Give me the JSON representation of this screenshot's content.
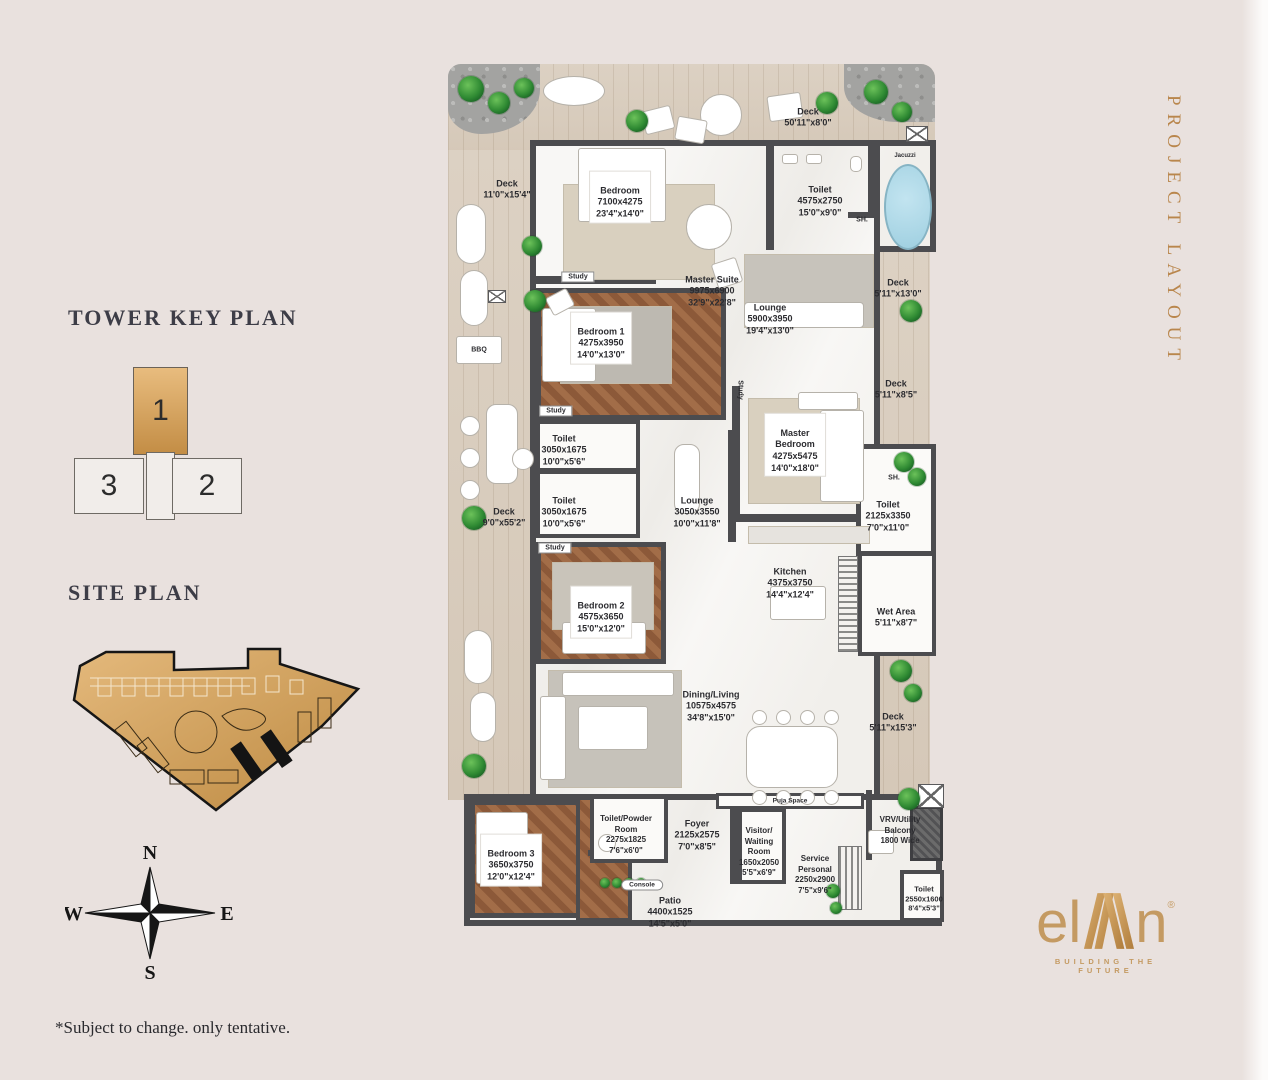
{
  "titles": {
    "tower_key_plan": "TOWER KEY PLAN",
    "site_plan": "SITE PLAN",
    "project_layout": "PROJECT LAYOUT",
    "disclaimer": "*Subject to change. only tentative."
  },
  "tower_key_plan": {
    "unit_highlight": "1",
    "unit_left": "3",
    "unit_right": "2"
  },
  "compass": {
    "n": "N",
    "e": "E",
    "s": "S",
    "w": "W"
  },
  "logo": {
    "brand_prefix": "el",
    "brand_suffix": "n",
    "registered": "®",
    "tagline": "BUILDING THE FUTURE"
  },
  "colors": {
    "gold": "#c49a62",
    "wall": "#4c4c4f",
    "wood": "#d9cec0",
    "background": "#e9e1de",
    "jacuzzi_blue": "#a9d6e6"
  },
  "rooms": {
    "deck_top": {
      "n": "Deck",
      "f": "50'11\"x8'0\""
    },
    "deck_left_top": {
      "n": "Deck",
      "f": "11'0\"x15'4\""
    },
    "bedroom_top": {
      "n": "Bedroom",
      "m": "7100x4275",
      "f": "23'4\"x14'0\""
    },
    "toilet_top": {
      "n": "Toilet",
      "m": "4575x2750",
      "f": "15'0\"x9'0\""
    },
    "sh": {
      "n": "SH."
    },
    "jacuzzi": {
      "n": "Jacuzzi"
    },
    "master_suite": {
      "n": "Master Suite",
      "m": "9975x6900",
      "f": "32'9\"x22'8\""
    },
    "lounge_top": {
      "n": "Lounge",
      "m": "5900x3950",
      "f": "19'4\"x13'0\""
    },
    "deck_right_1": {
      "n": "Deck",
      "f": "5'11\"x13'0\""
    },
    "bedroom1": {
      "n": "Bedroom 1",
      "m": "4275x3950",
      "f": "14'0\"x13'0\""
    },
    "bbq": {
      "n": "BBQ"
    },
    "study": {
      "n": "Study"
    },
    "deck_right_2": {
      "n": "Deck",
      "f": "5'11\"x8'5\""
    },
    "toilet_a": {
      "n": "Toilet",
      "m": "3050x1675",
      "f": "10'0\"x5'6\""
    },
    "toilet_b": {
      "n": "Toilet",
      "m": "3050x1675",
      "f": "10'0\"x5'6\""
    },
    "master_bedroom": {
      "n": "Master\nBedroom",
      "m": "4275x5475",
      "f": "14'0\"x18'0\""
    },
    "deck_left_long": {
      "n": "Deck",
      "f": "9'0\"x55'2\""
    },
    "lounge_small": {
      "n": "Lounge",
      "m": "3050x3550",
      "f": "10'0\"x11'8\""
    },
    "toilet_master": {
      "n": "Toilet",
      "m": "2125x3350",
      "f": "7'0\"x11'0\""
    },
    "kitchen": {
      "n": "Kitchen",
      "m": "4375x3750",
      "f": "14'4\"x12'4\""
    },
    "wet_area": {
      "n": "Wet Area",
      "f": "5'11\"x8'7\""
    },
    "bedroom2": {
      "n": "Bedroom 2",
      "m": "4575x3650",
      "f": "15'0\"x12'0\""
    },
    "dining_living": {
      "n": "Dining/Living",
      "m": "10575x4575",
      "f": "34'8\"x15'0\""
    },
    "deck_right_3": {
      "n": "Deck",
      "f": "5'11\"x15'3\""
    },
    "puja": {
      "n": "Puja Space"
    },
    "bedroom3": {
      "n": "Bedroom 3",
      "m": "3650x3750",
      "f": "12'0\"x12'4\""
    },
    "toilet_powder": {
      "n": "Toilet/Powder\nRoom",
      "m": "2275x1825",
      "f": "7'6\"x6'0\""
    },
    "foyer": {
      "n": "Foyer",
      "m": "2125x2575",
      "f": "7'0\"x8'5\""
    },
    "visitor": {
      "n": "Visitor/\nWaiting\nRoom",
      "m": "1650x2050",
      "f": "5'5\"x6'9\""
    },
    "service": {
      "n": "Service\nPersonal",
      "m": "2250x2900",
      "f": "7'5\"x9'6\""
    },
    "vrv": {
      "n": "VRV/Utility\nBalcony",
      "note": "1800 Wide"
    },
    "console": {
      "n": "Console"
    },
    "toilet_service": {
      "n": "Toilet",
      "m": "2550x1600",
      "f": "8'4\"x5'3\""
    },
    "patio": {
      "n": "Patio",
      "m": "4400x1525",
      "f": "14'5\"x5'0\""
    }
  }
}
